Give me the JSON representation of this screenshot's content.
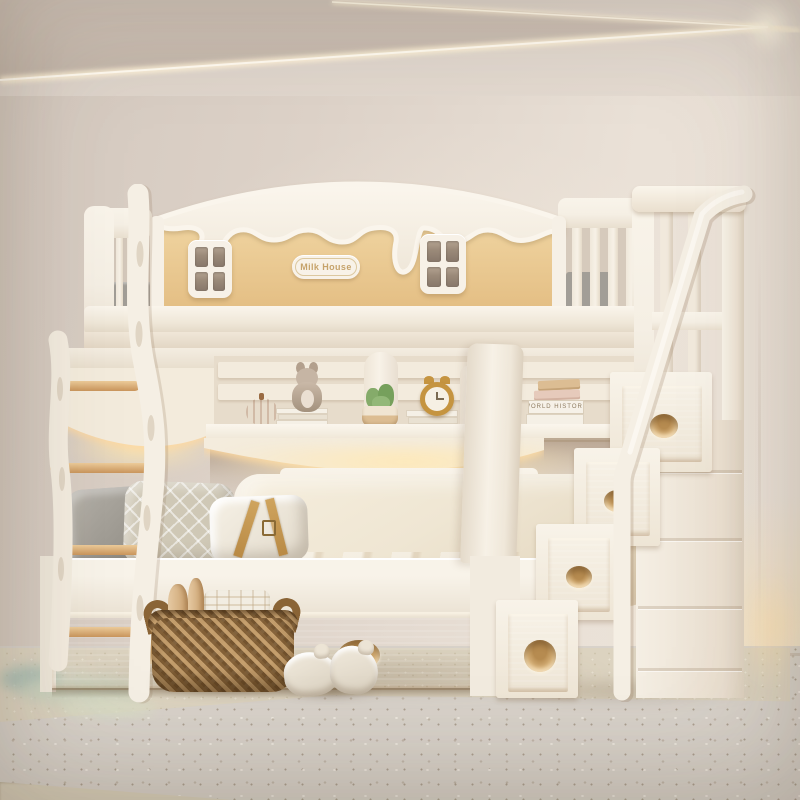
{
  "meta": {
    "scene": "children bunk bed product photo",
    "style": "cream and natural wood nursery"
  },
  "bed": {
    "badge_text": "Milk House"
  },
  "books": {
    "spine_text": "WORLD HISTORY"
  },
  "decor": {
    "shelf_items": [
      "pumpkin ornament",
      "plush fox on books",
      "potted succulent",
      "gold alarm clock on books",
      "stacked books with pink and tan books"
    ],
    "bedding": [
      "gray pillow",
      "diamond quilted pillow",
      "white buckle pillow",
      "gray bolster roll",
      "cream duvet"
    ],
    "floor_items": [
      "woven seagrass basket with towels and wooden toys",
      "pair of plush slippers"
    ]
  },
  "colors": {
    "wall": "#d8cdc3",
    "wall_light": "#eae1d7",
    "ceiling_wedge": "#c8bcb1",
    "led_glow": "#fff3d8",
    "cream": "#f5efe4",
    "cream_dark": "#e6dccb",
    "wood": "#eccb94",
    "wood_deep": "#d9b377",
    "window_pane": "#87776a",
    "gray_bedding": "#a19d96",
    "duvet": "#efe6d3",
    "rug": "#dcd3c0",
    "floor": "#d8d2ca",
    "sage": "#ccd3bf",
    "teal": "#a4bcb3",
    "basket": "#9a7442",
    "badge_ink": "#c6a36b",
    "shelf_glow": "#ffe8bc"
  }
}
